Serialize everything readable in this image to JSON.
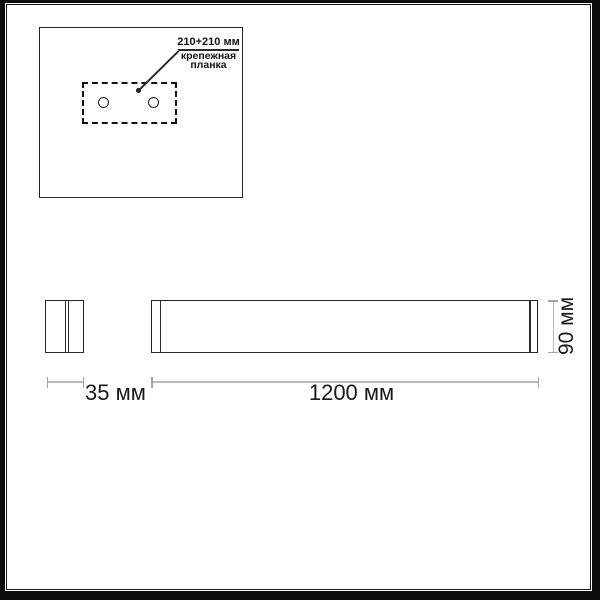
{
  "inset": {
    "dimension_label": "210+210 мм",
    "part_label_line1": "крепежная",
    "part_label_line2": "планка"
  },
  "dimensions": {
    "depth": "35 мм",
    "width": "1200 мм",
    "height": "90 мм"
  },
  "colors": {
    "background": "#ffffff",
    "frame": "#0c0c0c",
    "outline": "#262626",
    "dashed_outline": "#131313",
    "dimension_line": "#b9b9b9",
    "dimension_tick": "#a3a3a3",
    "text": "#191919"
  }
}
